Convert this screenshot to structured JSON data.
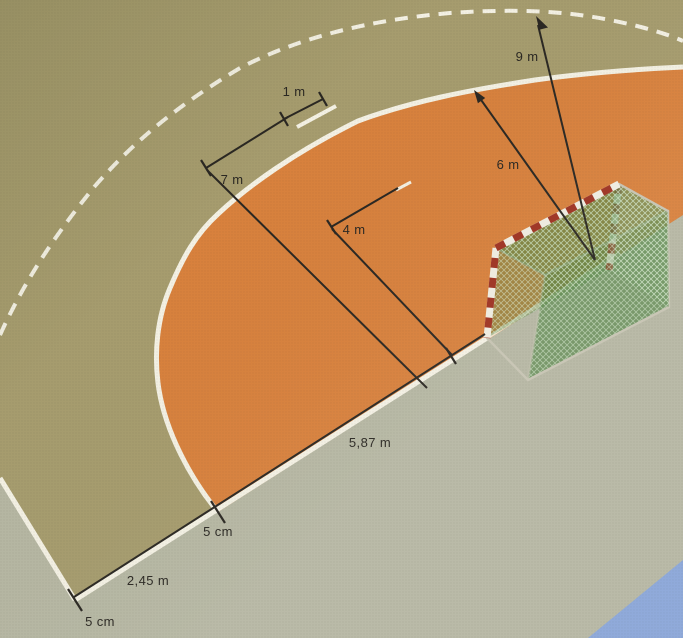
{
  "diagram": {
    "labels": {
      "nine_m": "9 m",
      "six_m": "6 m",
      "seven_m": "7 m",
      "four_m": "4 m",
      "one_m": "1 m",
      "goal_to_area": "5,87 m",
      "corner_to_area": "2,45 m",
      "line_width_upper": "5 cm",
      "line_width_lower": "5 cm"
    },
    "colors": {
      "court_floor": "#a69c6e",
      "outer_floor": "#b6b7a3",
      "goal_area_orange": "#d8813d",
      "line_white": "#f4f1e4",
      "dimension_black": "#2a2722",
      "net_green": "#4e8a44",
      "post_red": "#9e3322",
      "post_white": "#efece1",
      "frame_grey": "#c6c3b2",
      "blue_floor": "#8aa6d8"
    }
  }
}
